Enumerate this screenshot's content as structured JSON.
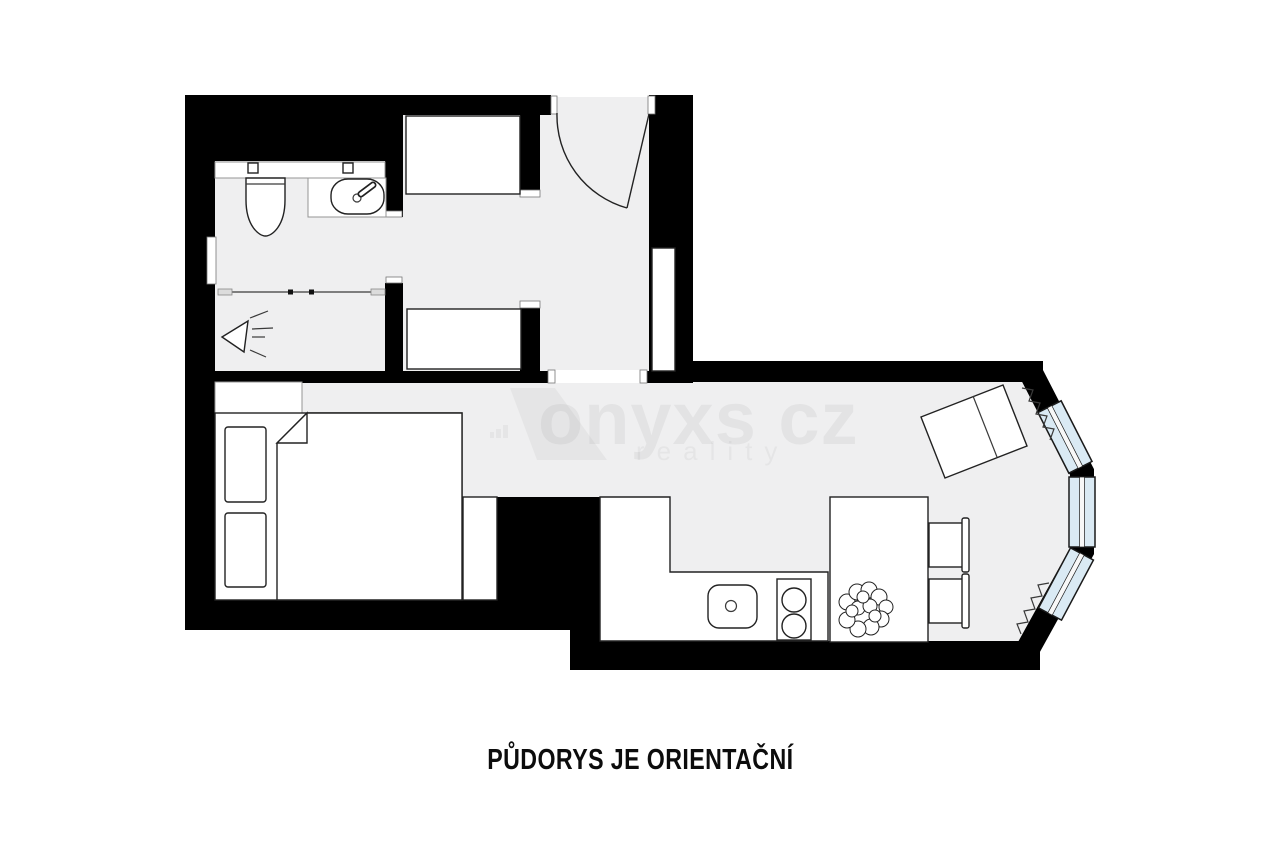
{
  "caption": {
    "text": "PŮDORYS JE ORIENTAČNÍ"
  },
  "watermark": {
    "brand": "onyxs cz",
    "tagline": "reality"
  },
  "colors": {
    "background": "#ffffff",
    "wall": "#000000",
    "floor": "#efeff0",
    "window_glass": "#daeaf4",
    "outline": "#222222",
    "watermark_text": "rgba(17,17,17,0.05)",
    "watermark_shape": "rgba(17,17,17,0.045)"
  },
  "plan_elements": {
    "fixtures": [
      "toilet-icon",
      "washbasin-icon",
      "shower-screen-icon",
      "shower-head-icon",
      "wardrobe-icon",
      "entry-door-icon",
      "hall-shelf-icon",
      "double-bed-icon",
      "pillow-icon",
      "bedside-table-icon",
      "kitchen-counter-icon",
      "kitchen-sink-icon",
      "hob-icon",
      "dining-table-icon",
      "potted-plant-icon",
      "chair-icon",
      "desk-icon",
      "radiator-icon",
      "bay-window-icon"
    ]
  }
}
